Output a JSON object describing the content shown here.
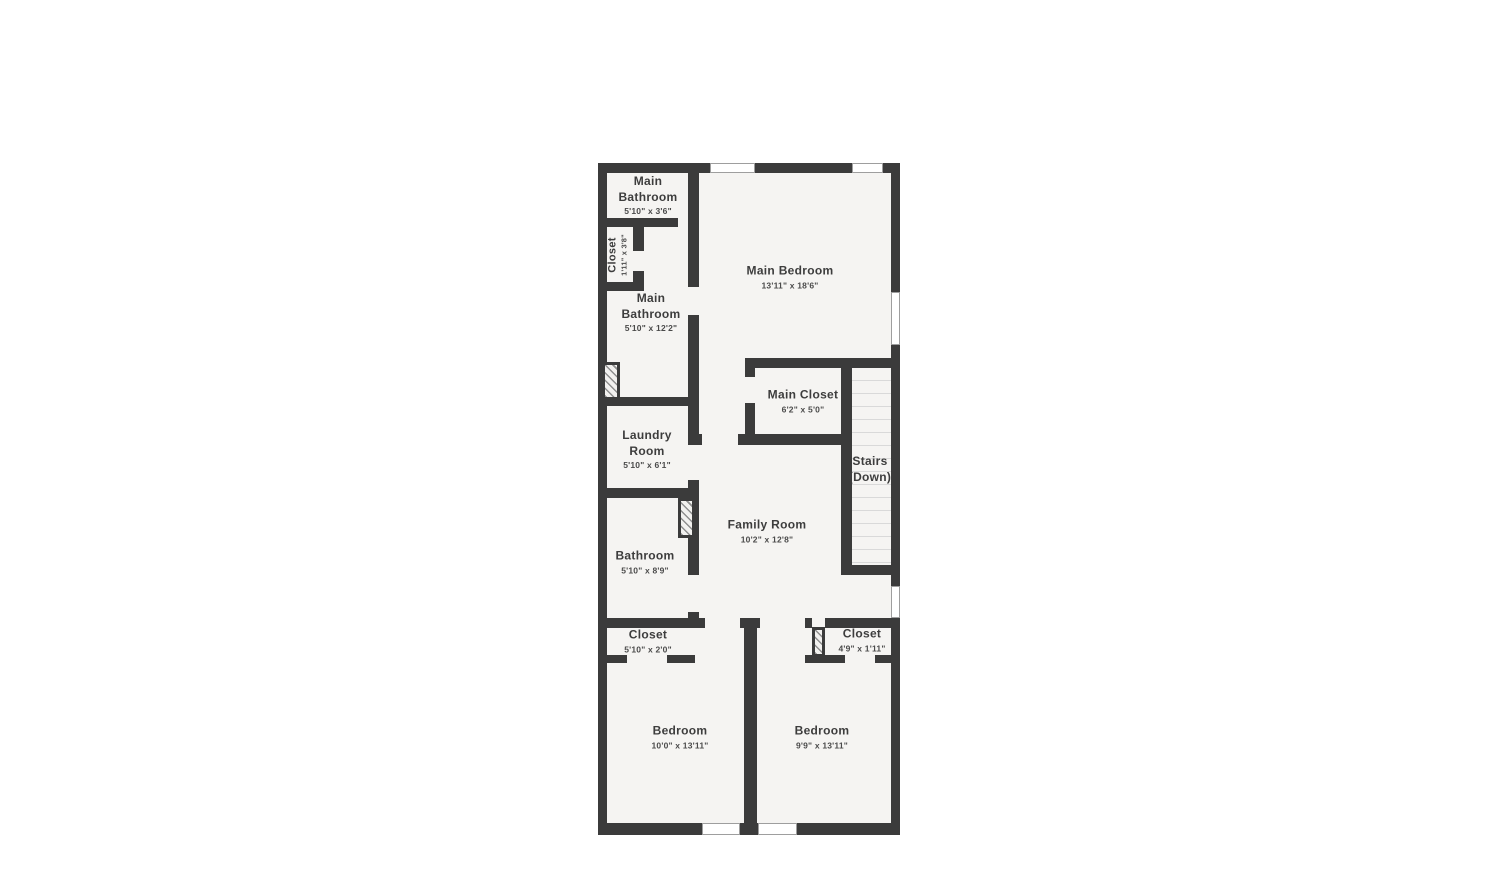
{
  "colors": {
    "wall": "#3b3b3b",
    "floor": "#f5f4f2",
    "text": "#3d3d3d",
    "dims_text": "#4a4a4a",
    "window_frame": "#9e9e9e",
    "stair_tread": "#d9d9d9",
    "hatch_line": "#8f8f8f"
  },
  "rooms": {
    "main_bathroom_upper": {
      "name": "Main Bathroom",
      "dims": "5'10\" x 3'6\""
    },
    "closet_hall": {
      "name": "Closet",
      "dims": "1'11\" x 3'8\""
    },
    "main_bathroom_lower": {
      "name": "Main Bathroom",
      "dims": "5'10\" x 12'2\""
    },
    "main_bedroom": {
      "name": "Main Bedroom",
      "dims": "13'11\" x 18'6\""
    },
    "main_closet": {
      "name": "Main Closet",
      "dims": "6'2\" x 5'0\""
    },
    "laundry": {
      "name": "Laundry Room",
      "dims": "5'10\" x 6'1\""
    },
    "stairs": {
      "name": "Stairs",
      "dims": "(Down)"
    },
    "family_room": {
      "name": "Family Room",
      "dims": "10'2\" x 12'8\""
    },
    "bathroom": {
      "name": "Bathroom",
      "dims": "5'10\" x 8'9\""
    },
    "closet_left": {
      "name": "Closet",
      "dims": "5'10\" x 2'0\""
    },
    "closet_right": {
      "name": "Closet",
      "dims": "4'9\" x 1'11\""
    },
    "bedroom_left": {
      "name": "Bedroom",
      "dims": "10'0\" x 13'11\""
    },
    "bedroom_right": {
      "name": "Bedroom",
      "dims": "9'9\" x 13'11\""
    }
  }
}
